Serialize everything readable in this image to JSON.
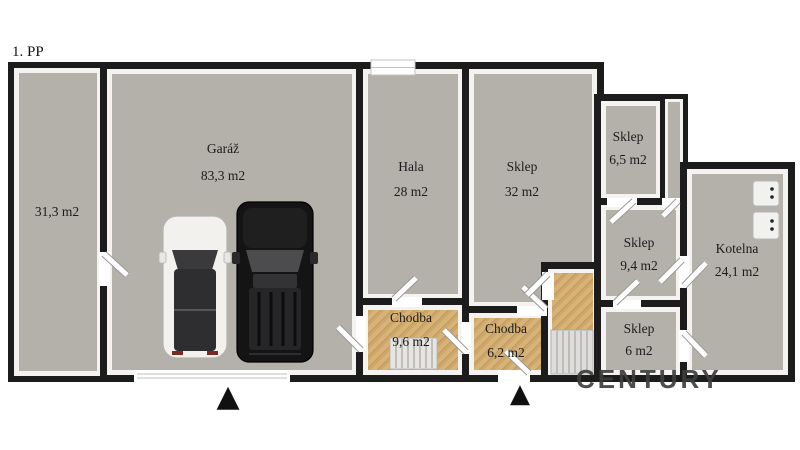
{
  "plan": {
    "floor_label": "1. PP",
    "watermark": "CENTURY",
    "entrance_marker": "▲",
    "rooms": {
      "left": {
        "area": "31,3 m2"
      },
      "garaz": {
        "name": "Garáž",
        "area": "83,3 m2"
      },
      "hala": {
        "name": "Hala",
        "area": "28 m2"
      },
      "sklep32": {
        "name": "Sklep",
        "area": "32 m2"
      },
      "sklep65": {
        "name": "Sklep",
        "area": "6,5 m2"
      },
      "sklep94": {
        "name": "Sklep",
        "area": "9,4 m2"
      },
      "sklep6": {
        "name": "Sklep",
        "area": "6 m2"
      },
      "kotelna": {
        "name": "Kotelna",
        "area": "24,1 m2"
      },
      "chodba96": {
        "name": "Chodba",
        "area": "9,6 m2"
      },
      "chodba62": {
        "name": "Chodba",
        "area": "6,2 m2"
      }
    },
    "colors": {
      "wall": "#1c1c1c",
      "wall_inner": "#f4f3f0",
      "floor_concrete": "#b4b1aa",
      "floor_parquet": "#d7b377",
      "floor_parquet_dark": "#b98f52",
      "background": "#ffffff",
      "arrow": "#111111"
    }
  }
}
